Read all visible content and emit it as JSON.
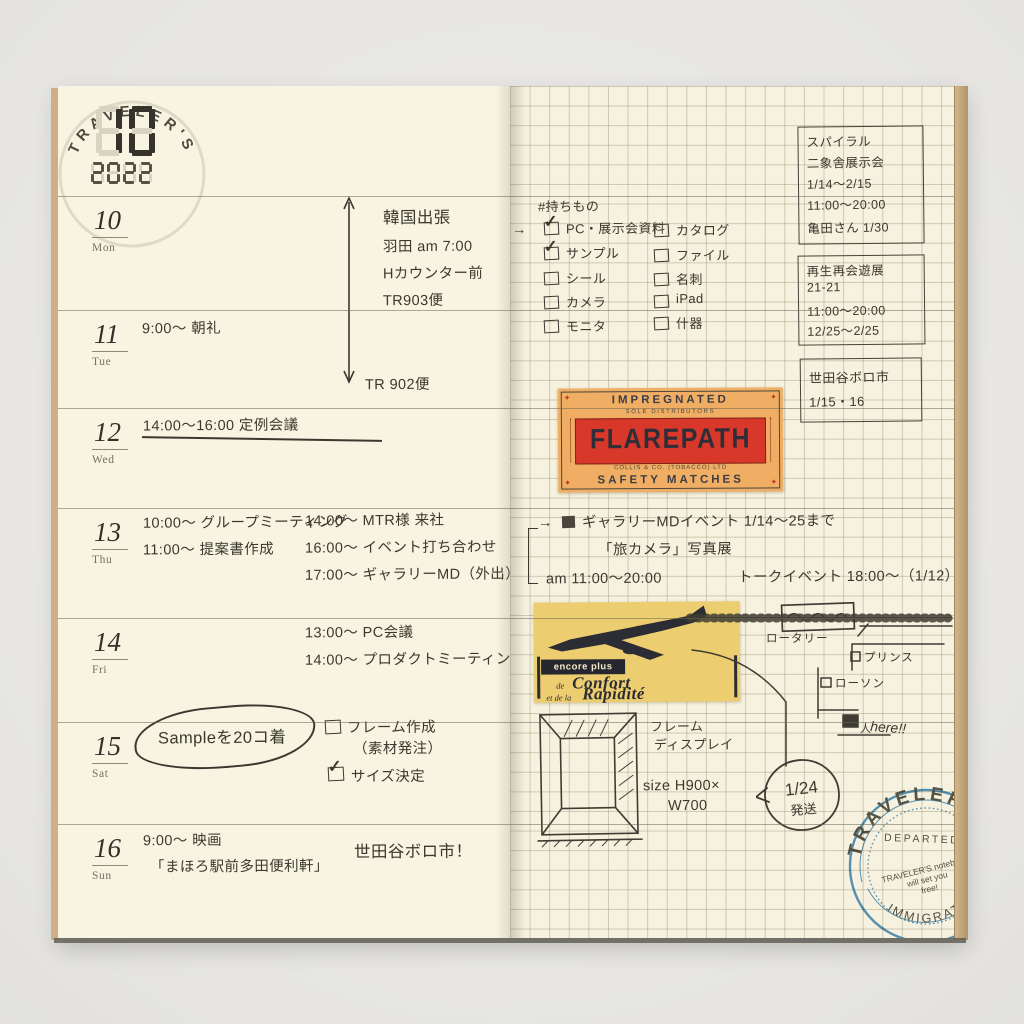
{
  "calendar": {
    "month": "10",
    "year": "2022",
    "watermark": "TRAVELER'S"
  },
  "days": [
    {
      "num": "10",
      "wd": "Mon"
    },
    {
      "num": "11",
      "wd": "Tue",
      "note": "9:00〜 朝礼"
    },
    {
      "num": "12",
      "wd": "Wed",
      "note": "14:00〜16:00 定例会議"
    },
    {
      "num": "13",
      "wd": "Thu",
      "left": [
        "10:00〜 グループミーティング",
        "11:00〜 提案書作成"
      ],
      "right": [
        "14:00〜 MTR様 来社",
        "16:00〜 イベント打ち合わせ",
        "17:00〜 ギャラリーMD（外出）"
      ]
    },
    {
      "num": "14",
      "wd": "Fri",
      "notes": [
        "13:00〜 PC会議",
        "14:00〜 プロダクトミーティング"
      ]
    },
    {
      "num": "15",
      "wd": "Sat",
      "circled": "Sampleを20コ着",
      "tasks": [
        {
          "label": "フレーム作成",
          "sub": "（素材発注）",
          "checked": false
        },
        {
          "label": "サイズ決定",
          "checked": true
        }
      ]
    },
    {
      "num": "16",
      "wd": "Sun",
      "notes": [
        "9:00〜 映画",
        "「まほろ駅前多田便利軒」"
      ],
      "side": "世田谷ボロ市！"
    }
  ],
  "trip": {
    "dest": "韓国出張",
    "lines": [
      "羽田 am 7:00",
      "Hカウンター前",
      "TR903便"
    ],
    "return_flight": "TR 902便"
  },
  "packlist": {
    "heading": "#持ちもの",
    "arrow": "→",
    "col1": [
      {
        "t": "PC・展示会資料",
        "c": true
      },
      {
        "t": "サンプル",
        "c": true
      },
      {
        "t": "シール",
        "c": false
      },
      {
        "t": "カメラ",
        "c": false
      },
      {
        "t": "モニタ",
        "c": false
      }
    ],
    "col2": [
      {
        "t": "カタログ",
        "c": false
      },
      {
        "t": "ファイル",
        "c": false
      },
      {
        "t": "名刺",
        "c": false
      },
      {
        "t": "iPad",
        "c": false
      },
      {
        "t": "什器",
        "c": false
      }
    ]
  },
  "event_boxes": [
    {
      "lines": [
        "スパイラル",
        "二象舎展示会",
        "1/14〜2/15",
        "11:00〜20:00",
        "亀田さん 1/30"
      ]
    },
    {
      "lines": [
        "再生再会遊展",
        "21-21",
        "11:00〜20:00",
        "12/25〜2/25"
      ]
    },
    {
      "lines": [
        "世田谷ボロ市",
        "1/15・16"
      ]
    }
  ],
  "gallery_note": {
    "arrow": "→",
    "line1": "ギャラリーMDイベント 1/14〜25まで",
    "line2": "「旅カメラ」写真展",
    "line3a": "am 11:00〜20:00",
    "line3b": "トークイベント 18:00〜（1/12）"
  },
  "flarepath": {
    "top": "IMPREGNATED",
    "sub": "SOLE DISTRIBUTORS",
    "name": "FLAREPATH",
    "maker": "COLLIS & CO. (TOBACCO) LTD",
    "bottom": "SAFETY MATCHES"
  },
  "plane_ad": {
    "tag": "encore plus",
    "small1": "de",
    "word1": "Confort",
    "small2": "et de la",
    "word2": "Rapidité"
  },
  "map": {
    "rotary": "ロータリー",
    "prince": "プリンス",
    "lawson": "ローソン",
    "figure": "人",
    "here": "here!!"
  },
  "frame_note": {
    "l1": "フレーム",
    "l2": "ディスプレイ",
    "size1": "size H900×",
    "size2": "W700",
    "bubble_top": "1/24",
    "bubble_bottom": "発送"
  },
  "stamp": {
    "arc_top": "TRAVELER'S",
    "band": "DEPARTED",
    "mid1": "TRAVELER'S notebook",
    "mid2": "will set you",
    "mid3": "free!",
    "arc_bottom": "IMMIGRATION"
  },
  "colors": {
    "ink": "#3b382f",
    "page": "#f7f4e2",
    "stamp_blue": "#3a86c1",
    "flarepath_orange": "#efae63",
    "flarepath_red": "#d8382a",
    "plane_yellow": "#eccd6f"
  }
}
